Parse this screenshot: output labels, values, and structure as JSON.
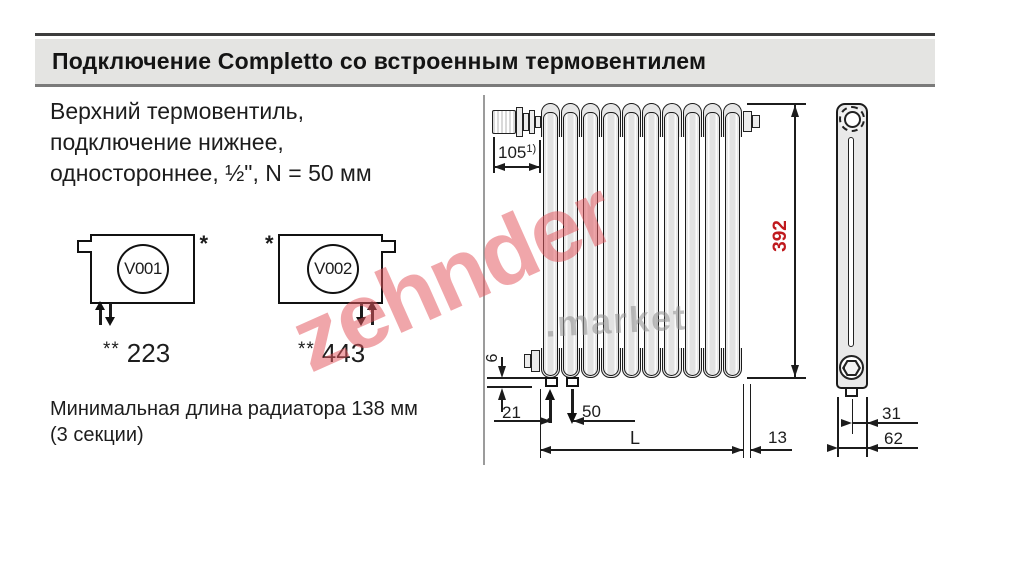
{
  "header": {
    "title": "Подключение Completto со встроенным термовентилем"
  },
  "intro": {
    "line1": "Верхний термовентиль,",
    "line2": "подключение нижнее,",
    "line3": "одностороннее, ½\", N = 50 мм"
  },
  "schemes": {
    "v001": {
      "code": "V001",
      "asterisk": "*",
      "stars": "**",
      "value": "223"
    },
    "v002": {
      "code": "V002",
      "asterisk": "*",
      "stars": "**",
      "value": "443"
    }
  },
  "note": {
    "line1": "Минимальная длина радиатора 138 мм",
    "line2": "(3 секции)"
  },
  "dims": {
    "valve_offset": "105",
    "valve_offset_note": "1)",
    "height": "392",
    "bottom_gap": "6",
    "edge_to_tapping": "21",
    "tapping_spacing": "50",
    "length": "L",
    "end_extension": "13",
    "bracket_depth": "31",
    "total_depth": "62"
  },
  "watermark": {
    "brand": "zehnder",
    "suffix": ".market"
  },
  "colors": {
    "dimension_red": "#c01a1e",
    "watermark_pink": "#e25860",
    "watermark_gray": "#9a9a9a",
    "header_band": "#e4e4e2"
  }
}
